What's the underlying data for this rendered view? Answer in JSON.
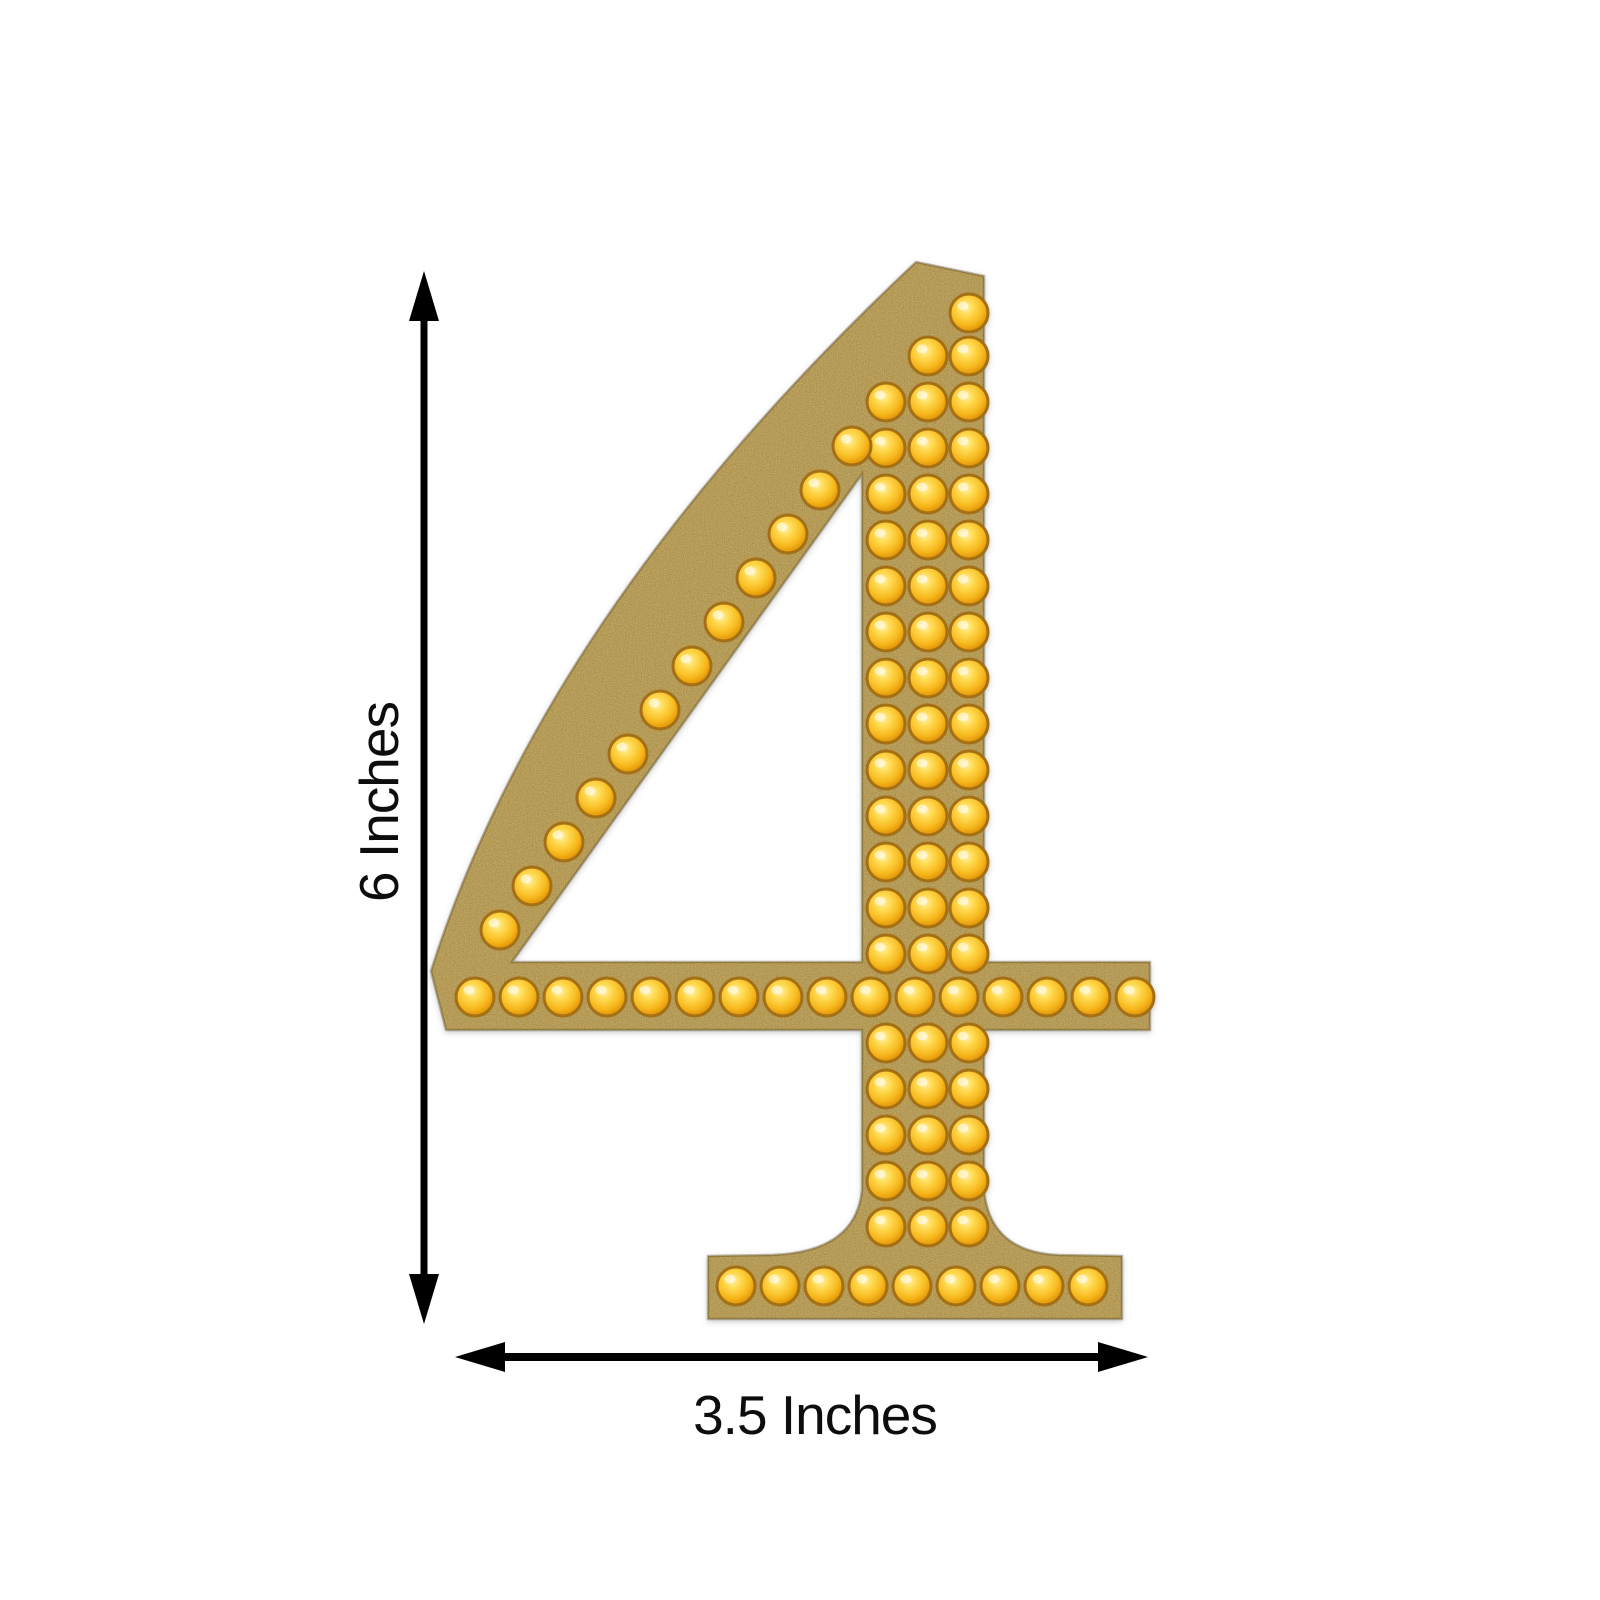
{
  "diagram": {
    "background": "#ffffff",
    "numeral": "4",
    "height_dimension": {
      "label": "6 Inches"
    },
    "width_dimension": {
      "label": "3.5 Inches"
    },
    "arrow_color": "#000000",
    "sticker": {
      "material": "gold-glitter",
      "colors": {
        "glitter_base": "#bfa054",
        "glitter_dark_speckle": "#5e4716",
        "glitter_light_speckle": "#f6e8ae",
        "stone_highlight": "#fff2a8",
        "stone_mid": "#ffd94f",
        "stone_deep": "#f7b81e",
        "stone_edge": "#c47c05",
        "stone_rim": "#a36f12"
      },
      "stones": {
        "radius": 19,
        "apex_stones": [
          [
            969,
            313
          ],
          [
            928,
            356
          ],
          [
            969,
            356
          ]
        ],
        "stem_columns": [
          886,
          928,
          969
        ],
        "stem_row_ys": [
          402,
          448,
          494,
          540,
          586,
          632,
          678,
          724,
          770,
          816,
          862,
          908,
          954,
          1043,
          1089,
          1135,
          1181,
          1227
        ],
        "diagonal_stones": [
          [
            852,
            446
          ],
          [
            820,
            490
          ],
          [
            788,
            534
          ],
          [
            756,
            578
          ],
          [
            724,
            622
          ],
          [
            692,
            666
          ],
          [
            660,
            710
          ],
          [
            628,
            754
          ],
          [
            596,
            798
          ],
          [
            564,
            842
          ],
          [
            532,
            886
          ],
          [
            500,
            930
          ]
        ],
        "crossbar_y": 997,
        "crossbar_xs": [
          475,
          519,
          563,
          607,
          651,
          695,
          739,
          783,
          827,
          871,
          915,
          959,
          1003,
          1047,
          1091,
          1135
        ],
        "base_y": 1286,
        "base_xs": [
          736,
          780,
          824,
          868,
          912,
          956,
          1000,
          1044,
          1088
        ]
      }
    }
  }
}
